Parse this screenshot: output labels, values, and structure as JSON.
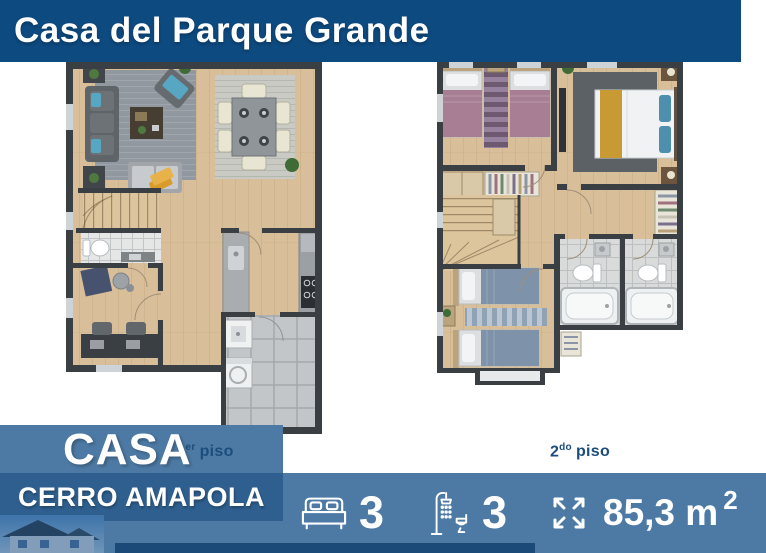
{
  "header": {
    "title": "Casa del Parque Grande"
  },
  "floorplans": {
    "first": {
      "caption_number": "1",
      "caption_ordinal": "er",
      "caption_word": "piso"
    },
    "second": {
      "caption_number": "2",
      "caption_ordinal": "do",
      "caption_word": "piso"
    }
  },
  "ribbon": {
    "label": "CASA"
  },
  "project": {
    "name": "CERRO AMAPOLA"
  },
  "stats": {
    "bedrooms": {
      "icon": "bed-icon",
      "value": "3"
    },
    "bathrooms": {
      "icon": "shower-toilet-icon",
      "value": "3"
    },
    "area": {
      "icon": "area-expand-icon",
      "value": "85,3 m",
      "exponent": "2"
    }
  },
  "colors": {
    "header_bg": "#0d4a80",
    "panel_bg": "#4d7aa4",
    "project_band_bg": "#2e5f8e",
    "caption_text": "#1d4d7c",
    "accent_strip": "#1c4a78"
  }
}
